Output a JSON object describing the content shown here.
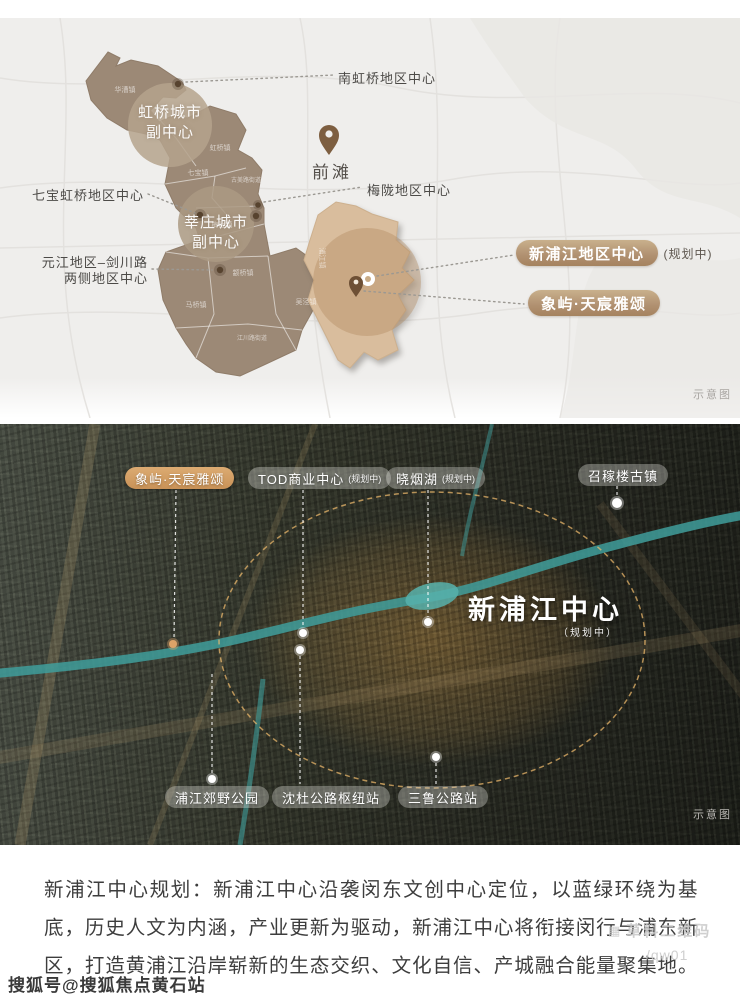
{
  "map": {
    "region_labels": {
      "nanhongqiao": "南虹桥地区中心",
      "hongqiao_l1": "虹桥城市",
      "hongqiao_l2": "副中心",
      "qibao": "七宝虹桥地区中心",
      "xinzhuang_l1": "莘庄城市",
      "xinzhuang_l2": "副中心",
      "yuanjiang_l1": "元江地区–剑川路",
      "yuanjiang_l2": "两侧地区中心",
      "qiantan": "前滩",
      "meilong": "梅陇地区中心"
    },
    "badges": {
      "new_pujiang": "新浦江地区中心",
      "new_pujiang_suffix": "(规划中)",
      "project": "象屿·天宸雅颂"
    },
    "town_labels": [
      "华漕镇",
      "虹桥镇",
      "七宝镇",
      "古美路街道",
      "梅陇镇",
      "颛桥镇",
      "马桥镇",
      "吴泾镇",
      "江川路街道",
      "浦江镇"
    ],
    "watermark": "示意图"
  },
  "photo": {
    "pills": [
      {
        "label": "象屿·天宸雅颂"
      },
      {
        "label": "TOD商业中心",
        "suffix": "(规划中)"
      },
      {
        "label": "晓烟湖",
        "suffix": "(规划中)"
      },
      {
        "label": "召稼楼古镇"
      },
      {
        "label": "浦江郊野公园"
      },
      {
        "label": "沈杜公路枢纽站"
      },
      {
        "label": "三鲁公路站"
      }
    ],
    "center_title": "新浦江中心",
    "center_subtitle": "（规划中）",
    "watermark": "示意图"
  },
  "description": {
    "line1": "新浦江中心规划：新浦江中心沿袭闵东文创中心定位，以蓝绿环绕为基",
    "line2": "底，历史人文为内涵，产业更新为驱动，新浦江中心将衔接闵行与浦东新",
    "line3": "区，打造黄浦江沿岸崭新的生态交织、文化自信、产城融合能量聚集地。"
  },
  "watermarks": {
    "qr_label": "草料二维码",
    "qr_code": "/qw01",
    "sohu": "搜狐号@搜狐焦点黄石站"
  },
  "colors": {
    "district_brown": "#9c8976",
    "pujiang_tan": "#d9bd9d",
    "badge_gold": "#b09070",
    "pill_orange": "#d2a068",
    "highlight_orange": "#e8aa50",
    "river_teal": "#4aa3a0"
  }
}
